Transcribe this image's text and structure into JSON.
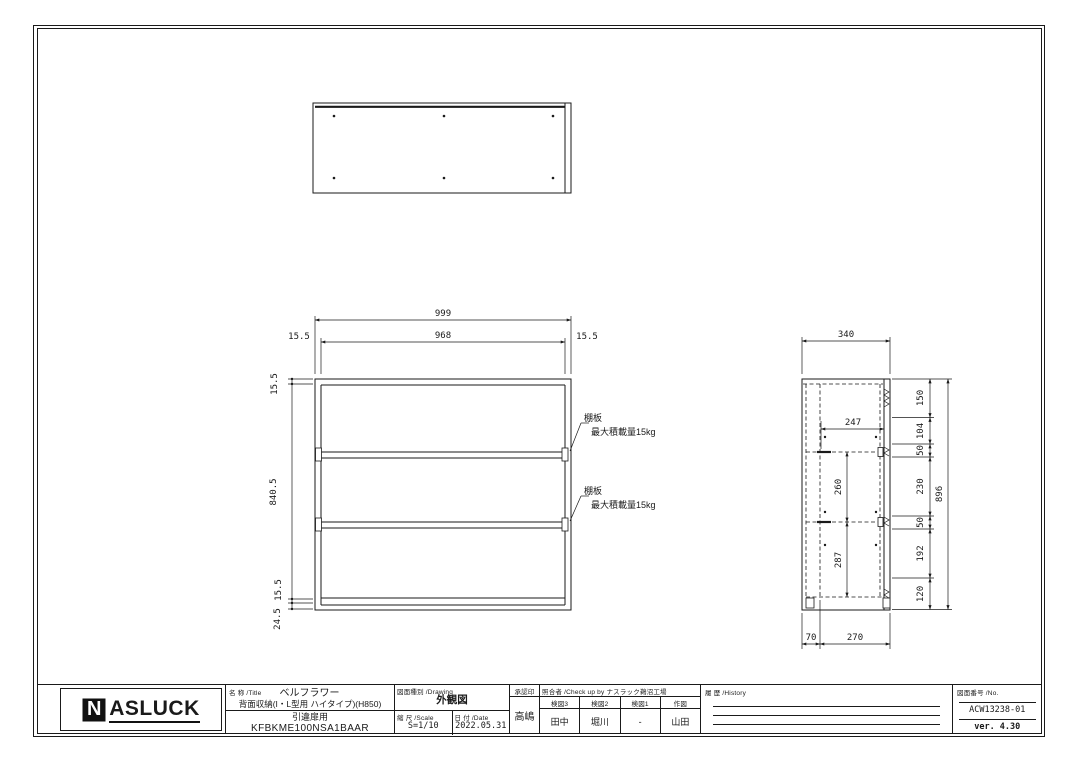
{
  "colors": {
    "ink": "#1a1a1a",
    "paper": "#ffffff"
  },
  "front_view": {
    "dim_overall_width": "999",
    "dim_inner_width": "968",
    "dim_left_margin": "15.5",
    "dim_right_margin": "15.5",
    "dim_top_panel": "15.5",
    "dim_body_height": "840.5",
    "dim_bottom_panel": "15.5",
    "dim_base": "24.5",
    "shelf_note_title": "棚板",
    "shelf_note_load": "最大積載量15kg"
  },
  "side_view": {
    "dim_overall_depth": "340",
    "dim_shelf_depth": "247",
    "height_chain": [
      "150",
      "104",
      "50",
      "230",
      "50",
      "192",
      "120"
    ],
    "dim_overall_height": "896",
    "dim_shelf_span_upper": "260",
    "dim_shelf_span_lower": "287",
    "dim_back_gap": "70",
    "dim_body_depth": "270"
  },
  "title_block": {
    "logo_initial": "N",
    "logo_rest": "ASLUCK",
    "name_label": "名 称 /Title",
    "product_name": "ベルフラワー",
    "product_desc": "背面収納(I・L型用 ハイタイプ)(H850)",
    "product_use": "引違扉用",
    "model_no": "KFBKME100NSA1BAAR",
    "drawing_type_label": "図面種別 /Drawing",
    "drawing_type": "外観図",
    "scale_label": "縮 尺 /Scale",
    "scale_value": "S=1/10",
    "date_label": "日 付 /Date",
    "date_value": "2022.05.31",
    "approval_label": "承認印",
    "approval_name": "高嶋",
    "check_label": "照合者 /Check up by ナスラック鵜沼工場",
    "check_cols": [
      {
        "label": "検図3",
        "name": "田中"
      },
      {
        "label": "検図2",
        "name": "堀川"
      },
      {
        "label": "検図1",
        "name": "-"
      },
      {
        "label": "作図",
        "name": "山田"
      }
    ],
    "history_label": "履 歴 /History",
    "drawing_no_label": "図面番号 /No.",
    "drawing_no": "ACW13238-01",
    "version": "ver. 4.30"
  }
}
